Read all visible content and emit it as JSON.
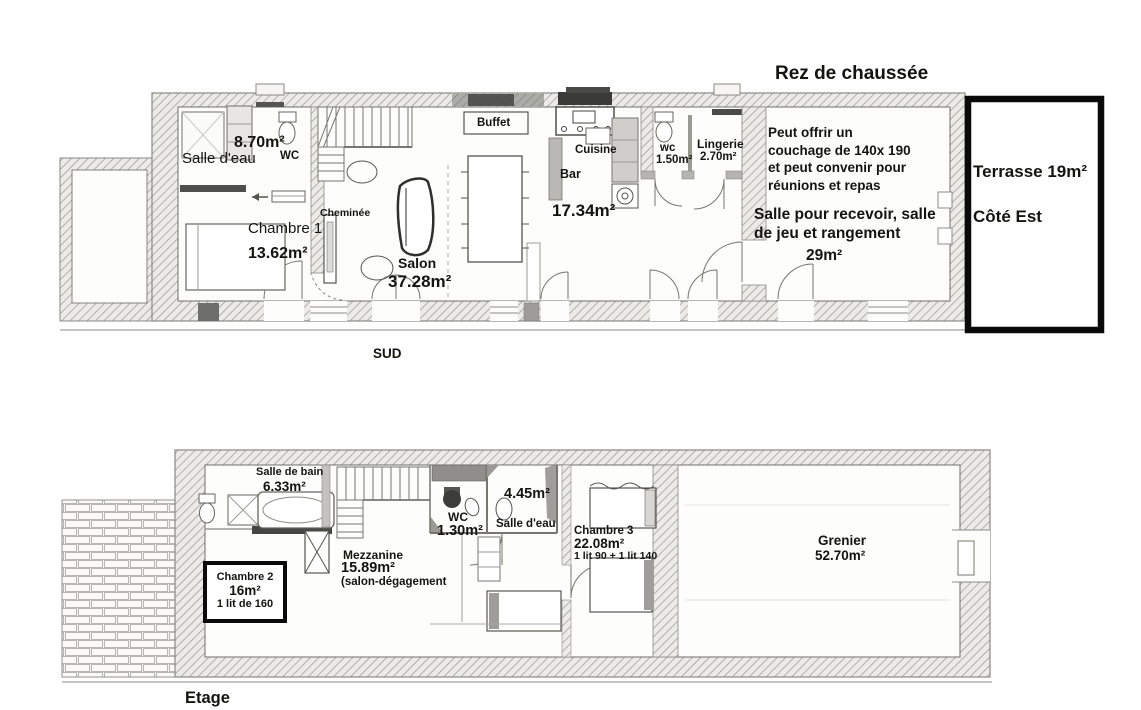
{
  "document": {
    "type": "house floor plan (scanned drawing with annotations)"
  },
  "colors": {
    "wall_hatch_bg": "#ecebe7",
    "wall_hatch_line": "#9b9b98",
    "heavy_outline": "#0a0a0a",
    "text": "#14140f",
    "paper": "#ffffff"
  },
  "ground_floor": {
    "title": "Rez de chaussée",
    "direction_label": "SUD",
    "labels": {
      "salle_eau_area": "8.70m²",
      "wc": "WC",
      "salle_eau": "Salle d'eau",
      "chambre1": "Chambre 1",
      "chambre1_area": "13.62m²",
      "cheminee": "Cheminée",
      "salon": "Salon",
      "salon_area": "37.28m²",
      "buffet": "Buffet",
      "cuisine": "Cuisine",
      "bar": "Bar",
      "cuisine_area": "17.34m²",
      "wc2": "wc",
      "wc2_area": "1.50m²",
      "lingerie": "Lingerie",
      "lingerie_area": "2.70m²",
      "reception_note": "Peut offrir un\ncouchage de 140x 190\net peut convenir pour\nréunions et repas",
      "reception_label": "Salle pour recevoir, salle\nde jeu et rangement",
      "reception_area": "29m²",
      "terrasse": "Terrasse 19m²",
      "cote_est": "Côté Est"
    }
  },
  "upper_floor": {
    "title": "Etage",
    "labels": {
      "salle_de_bain": "Salle de bain",
      "salle_de_bain_area": "6.33m²",
      "chambre2": "Chambre 2",
      "chambre2_area": "16m²",
      "chambre2_bed": "1 lit de 160",
      "mezzanine": "Mezzanine",
      "mezzanine_area": "15.89m²",
      "mezzanine_note": "(salon-dégagement",
      "wc": "WC",
      "wc_area": "1.30m²",
      "salle_eau_area": "4.45m²",
      "salle_eau": "Salle d'eau",
      "chambre3": "Chambre 3",
      "chambre3_area": "22.08m²",
      "chambre3_beds": "1 lit 90 + 1 lit 140",
      "grenier": "Grenier",
      "grenier_area": "52.70m²"
    }
  }
}
